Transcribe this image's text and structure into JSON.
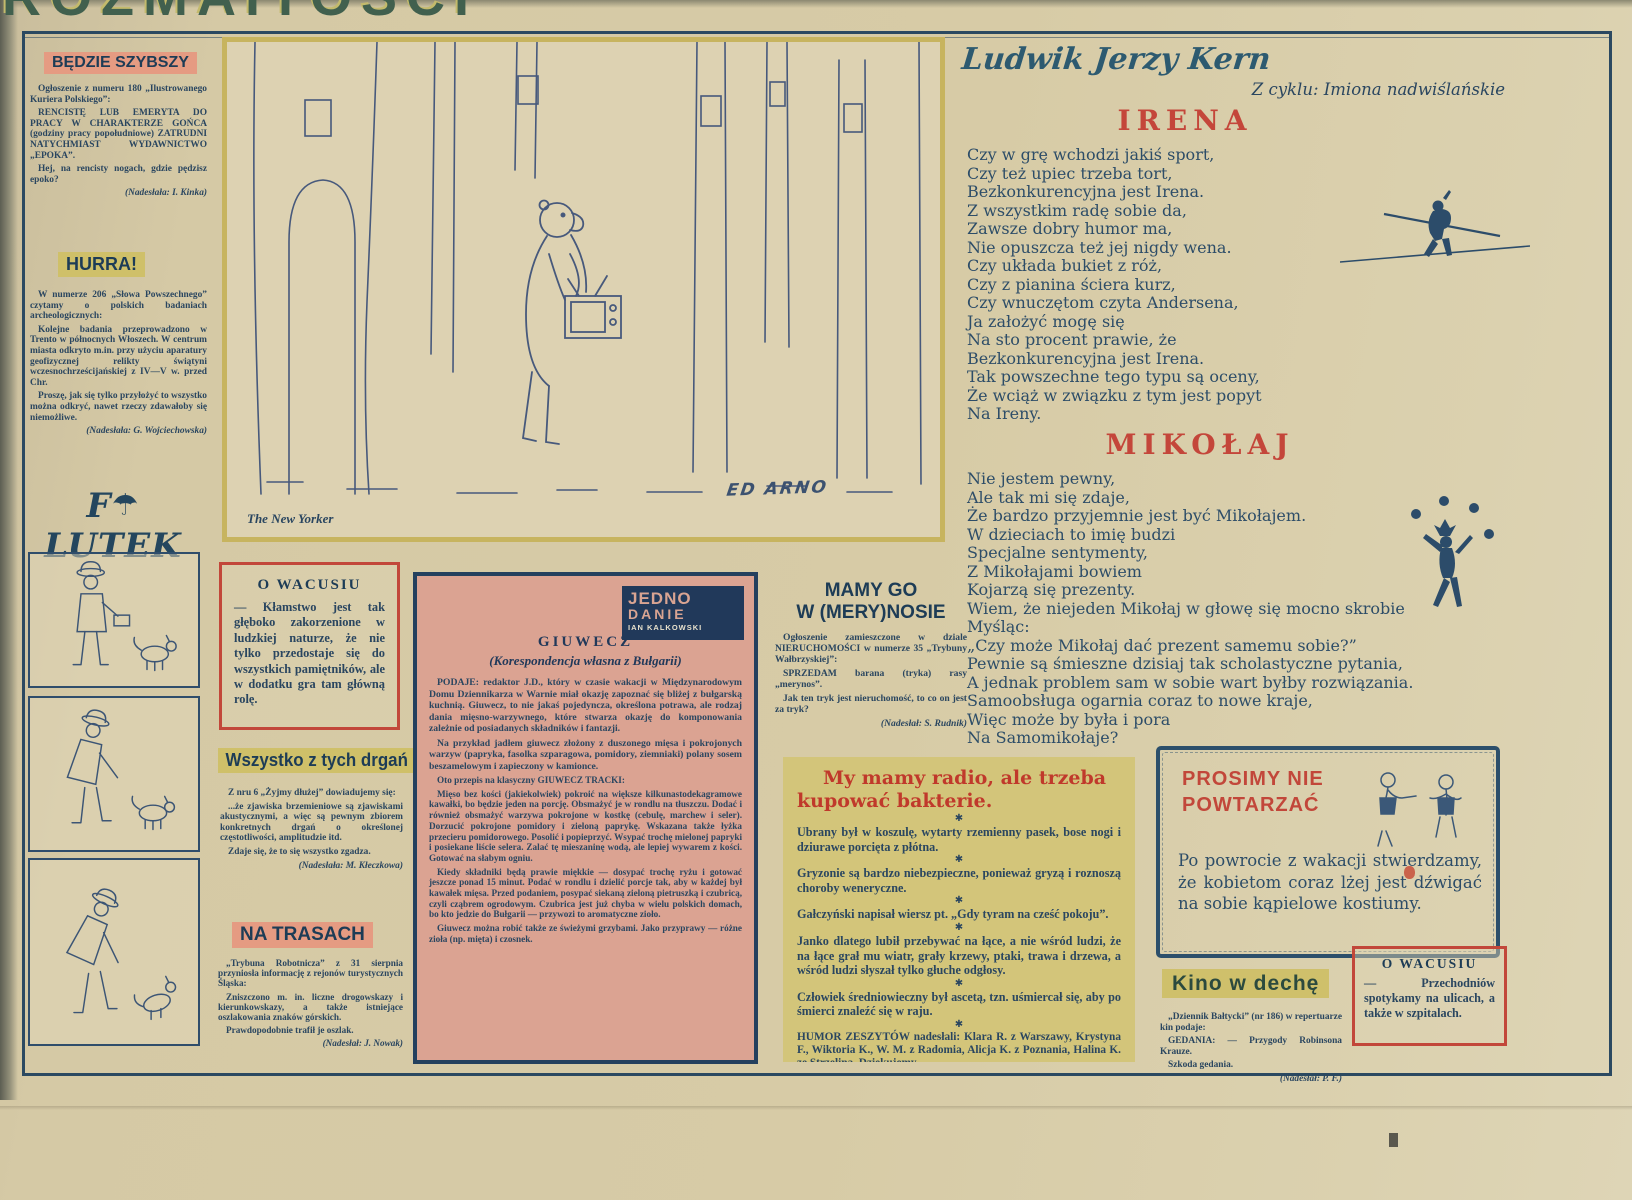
{
  "masthead": {
    "title": "ROZMAITOŚCI"
  },
  "left_column": {
    "bedzie": {
      "title": "BĘDZIE SZYBSZY",
      "p1": "Ogłoszenie z numeru 180 „Ilustrowanego Kuriera Polskiego”:",
      "p2": "RENCISTĘ LUB EMERYTA DO PRACY W CHARAKTERZE GOŃCA (godziny pracy popołudniowe) ZATRUDNI NATYCHMIAST WYDAWNICTWO „EPOKA”.",
      "p3": "Hej, na rencisty nogach, gdzie pędzisz epoko?",
      "credit": "(Nadesłała: I. Kinka)"
    },
    "hurra": {
      "title": "HURRA!",
      "p1": "W numerze 206 „Słowa Powszechnego” czytamy o polskich badaniach archeologicznych:",
      "p2": "Kolejne badania przeprowadzono w Trento w północnych Włoszech. W centrum miasta odkryto m.in. przy użyciu aparatury geofizycznej relikty świątyni wczesnochrześcijańskiej z IV—V w. przed Chr.",
      "p3": "Proszę, jak się tylko przyłożyć to wszystko można odkryć, nawet rzeczy zdawałoby się niemożliwe.",
      "credit": "(Nadesłała: G. Wojciechowska)"
    },
    "filutek": {
      "part1": "F",
      "umbrella_icon": "☂",
      "part2": "LUTEK"
    }
  },
  "cartoon": {
    "caption": "The New Yorker",
    "signature": "ED ARNO"
  },
  "middle": {
    "o_wacusiu": {
      "title": "O WACUSIU",
      "text": "— Kłamstwo jest tak głęboko zakorzenione w ludzkiej naturze, że nie tylko przedostaje się do wszystkich pamiętników, ale w dodatku gra tam główną rolę."
    },
    "drgania": {
      "title": "Wszystko z tych drgań",
      "p1": "Z nru 6 „Żyjmy dłużej” dowiadujemy się:",
      "p2": "...że zjawiska brzemieniowe są zjawiskami akustycznymi, a więc są pewnym zbiorem konkretnych drgań o określonej częstotliwości, amplitudzie itd.",
      "p3": "Zdaje się, że to się wszystko zgadza.",
      "credit": "(Nadesłała: M. Kłeczkowa)"
    },
    "na_trasach": {
      "title": "NA TRASACH",
      "p1": "„Trybuna Robotnicza” z 31 sierpnia przyniosła informację z rejonów turystycznych Śląska:",
      "p2": "Zniszczono m. in. liczne drogowskazy i kierunkowskazy, a także istniejące oszlakowania znaków górskich.",
      "p3": "Prawdopodobnie trafił je oszlak.",
      "credit": "(Nadesłał: J. Nowak)"
    }
  },
  "giuwecz": {
    "badge": {
      "line1": "JEDNO",
      "line2": "DANIE",
      "line3": "IAN KALKOWSKI"
    },
    "title": "GIUWECZ",
    "subtitle": "(Korespondencja własna z Bułgarii)",
    "p1_lead": "PODAJE: redaktor J.D., ",
    "p1_rest": "który w czasie wakacji w Międzynarodowym Domu Dziennikarza w Warnie miał okazję zapoznać się bliżej z bułgarską kuchnią. Giuwecz, to nie jakaś pojedyncza, określona potrawa, ale rodzaj dania mięsno-warzywnego, które stwarza okazję do komponowania zależnie od posiadanych składników i fantazji.",
    "p2": "Na przykład jadłem giuwecz złożony z duszonego mięsa i pokrojonych warzyw (papryka, fasolka szparagowa, pomidory, ziemniaki) polany sosem beszamelowym i zapieczony w kamionce.",
    "recipe_head": "Oto przepis na klasyczny GIUWECZ TRACKI:",
    "recipe_p1": "Mięso bez kości (jakiekolwiek) pokroić na większe kilkunastodekagramowe kawałki, bo będzie jeden na porcję. Obsmażyć je w rondlu na tłuszczu. Dodać i również obsmażyć warzywa pokrojone w kostkę (cebulę, marchew i seler). Dorzucić pokrojone pomidory i zieloną paprykę. Wskazana także łyżka przecieru pomidorowego. Posolić i popieprzyć. Wsypać trochę mielonej papryki i posiekane liście selera. Zalać tę mieszaninę wodą, ale lepiej wywarem z kości. Gotować na słabym ogniu.",
    "recipe_p2": "Kiedy składniki będą prawie miękkie — dosypać trochę ryżu i gotować jeszcze ponad 15 minut. Podać w rondlu i dzielić porcje tak, aby w każdej był kawałek mięsa. Przed podaniem, posypać siekaną zieloną pietruszką i czubricą, czyli cząbrem ogrodowym. Czubrica jest już chyba w wielu polskich domach, bo kto jedzie do Bułgarii — przywozi to aromatyczne zioło.",
    "recipe_p3": "Giuwecz można robić także ze świeżymi grzybami. Jako przyprawy — różne zioła (np. mięta) i czosnek."
  },
  "merynos": {
    "title": "MAMY GO\nW (MERY)NOSIE",
    "p1": "Ogłoszenie zamieszczone w dziale NIERUCHOMOŚCI w numerze 35 „Trybuny Wałbrzyskiej”:",
    "p2": "SPRZEDAM barana (tryka) rasy „merynos”.",
    "p3": "Jak ten tryk jest nieruchomość, to co on jest za tryk?",
    "credit": "(Nadesłał: S. Rudnik)"
  },
  "radio_box": {
    "title": "My mamy radio, ale trzeba kupować bakterie.",
    "star": "✱",
    "items": [
      "Ubrany był w koszulę, wytarty rzemienny pasek, bose nogi i dziurawe porcięta z płótna.",
      "Gryzonie są bardzo niebezpieczne, ponieważ gryzą i roznoszą choroby weneryczne.",
      "Gałczyński napisał wiersz pt. „Gdy tyram na cześć pokoju”.",
      "Janko dlatego lubił przebywać na łące, a nie wśród ludzi, że na łące grał mu wiatr, grały krzewy, ptaki, trawa i drzewa, a wśród ludzi słyszał tylko głuche odgłosy.",
      "Człowiek średniowieczny był ascetą, tzn. uśmiercał się, aby po śmierci znaleźć się w raju."
    ],
    "footer": "HUMOR ZESZYTÓW nadesłali: Klara R. z Warszawy, Krystyna F., Wiktoria K., W. M. z Radomia, Alicja K. z Poznania, Halina K. ze Strzelina. Dziękujemy."
  },
  "poems": {
    "author": "Ludwik Jerzy Kern",
    "cycle": "Z cyklu: Imiona nadwiślańskie",
    "irena": {
      "title": "IRENA",
      "text": "Czy w grę wchodzi jakiś sport,\nCzy też upiec trzeba tort,\nBezkonkurencyjna jest Irena.\nZ wszystkim radę sobie da,\nZawsze dobry humor ma,\nNie opuszcza też jej nigdy wena.\nCzy układa bukiet z róż,\nCzy z pianina ściera kurz,\nCzy wnuczętom czyta Andersena,\nJa założyć mogę się\nNa sto procent prawie, że\nBezkonkurencyjna jest Irena.\nTak powszechne tego typu są oceny,\nŻe wciąż w związku z tym jest popyt\nNa Ireny."
    },
    "mikolaj": {
      "title": "MIKOŁAJ",
      "text": "Nie jestem pewny,\nAle tak mi się zdaje,\nŻe bardzo przyjemnie jest być Mikołajem.\nW dzieciach to imię budzi\nSpecjalne sentymenty,\nZ Mikołajami bowiem\nKojarzą się prezenty.\nWiem, że niejeden Mikołaj w głowę się mocno skrobie\nMyśląc:\n„Czy może Mikołaj dać prezent samemu sobie?”\nPewnie są śmieszne dzisiaj tak scholastyczne pytania,\nA jednak problem sam w sobie wart byłby rozwiązania.\nSamoobsługa ogarnia coraz to nowe kraje,\nWięc może by była i pora\nNa Samomikołaje?"
    }
  },
  "prosimy": {
    "title": "PROSIMY NIE POWTARZAĆ",
    "text": "Po powrocie z wakacji stwierdzamy, że kobietom coraz lżej jest dźwigać na sobie kąpielowe kostiumy."
  },
  "kino": {
    "title": "Kino w dechę",
    "p1": "„Dziennik Bałtycki” (nr 186) w repertuarze kin podaje:",
    "p2": "GEDANIA: — Przygody Robinsona Krauze.",
    "p3": "Szkoda gedania.",
    "credit": "(Nadesłał: P. F.)"
  },
  "o_wacusiu_2": {
    "title": "O WACUSIU",
    "text": "— Przechodniów spotykamy na ulicach, a także w szpitalach."
  }
}
